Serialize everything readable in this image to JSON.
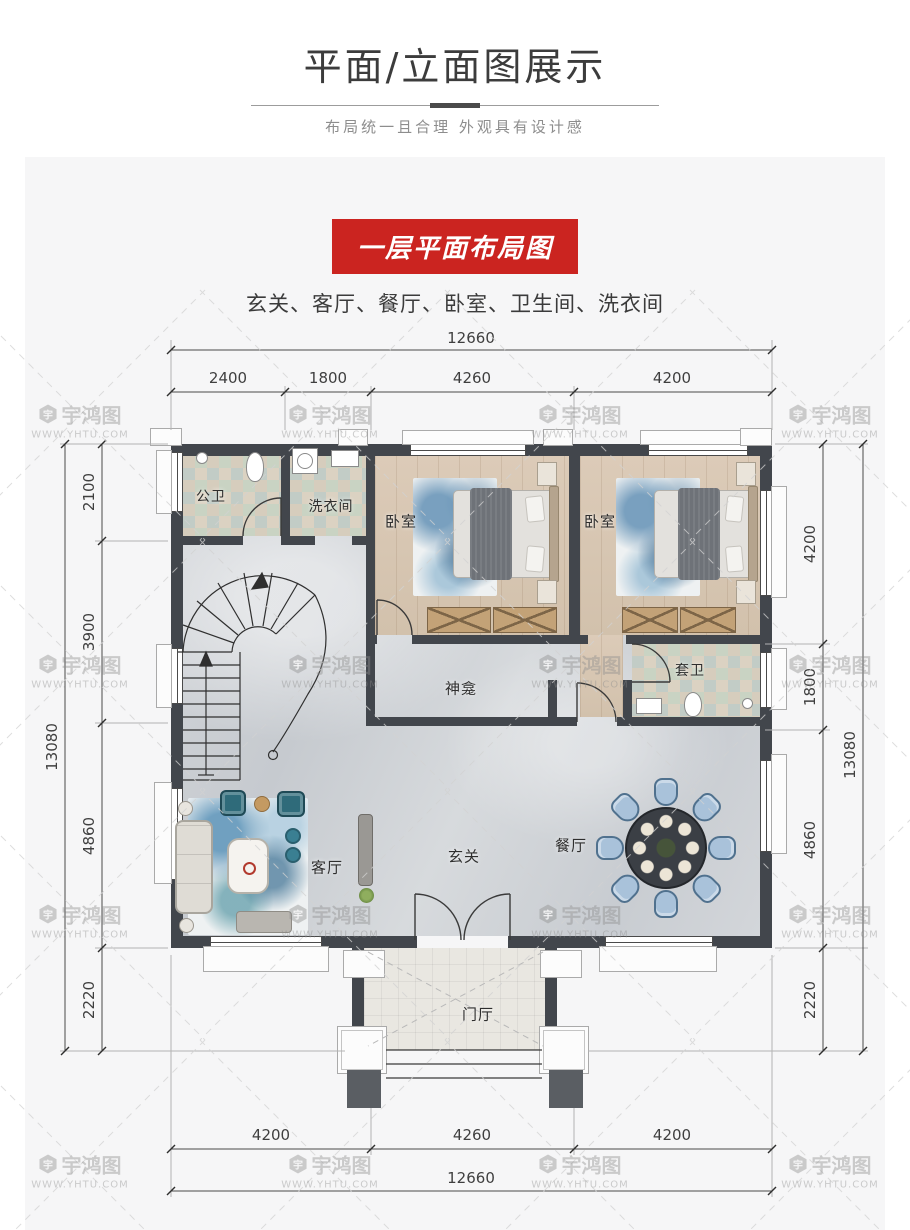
{
  "header": {
    "title": "平面/立面图展示",
    "subtitle": "布局统一且合理 外观具有设计感"
  },
  "banner": {
    "label": "一层平面布局图",
    "rooms_line": "玄关、客厅、餐厅、卧室、卫生间、洗衣间"
  },
  "watermark": {
    "logo_char": "宇",
    "brand": "宇鸿图",
    "url": "WWW.YHTU.COM"
  },
  "dims": {
    "top": {
      "total": "12660",
      "segments": [
        "2400",
        "1800",
        "4260",
        "4200"
      ]
    },
    "bottom": {
      "total": "12660",
      "segments": [
        "4200",
        "4260",
        "4200"
      ]
    },
    "left": {
      "total": "13080",
      "segments": [
        "2100",
        "3900",
        "4860",
        "2220"
      ]
    },
    "right": {
      "total": "13080",
      "segments": [
        "4200",
        "1800",
        "4860",
        "2220"
      ]
    }
  },
  "rooms": {
    "guest_bath": "公卫",
    "laundry": "洗衣间",
    "bedroom1": "卧室",
    "bedroom2": "卧室",
    "ensuite": "套卫",
    "shrine": "神龛",
    "living": "客厅",
    "foyer": "玄关",
    "dining": "餐厅",
    "porch": "门厅"
  },
  "colors": {
    "accent_red": "#cb2420",
    "wall": "#42464c",
    "marble": "#ccd0d4",
    "wood": "#d7c6b2",
    "panel_gray": "#f6f6f7"
  }
}
